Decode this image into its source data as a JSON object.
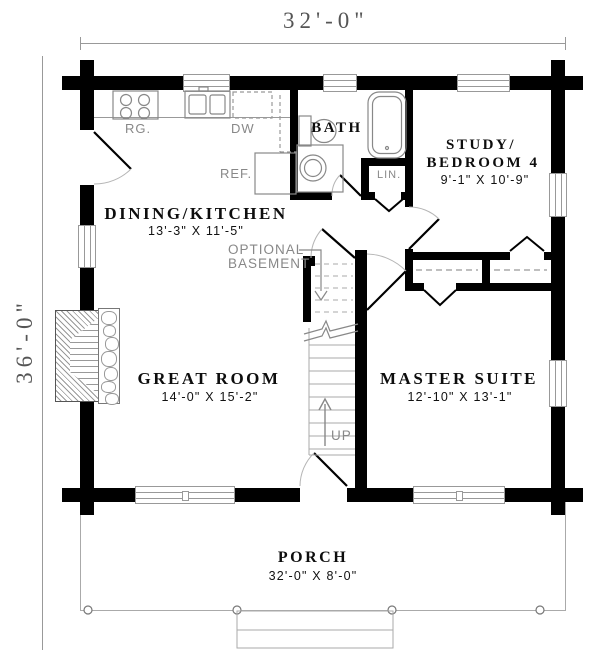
{
  "dimensions": {
    "overall_width": "32'-0\"",
    "overall_depth": "36'-0\""
  },
  "rooms": {
    "dining_kitchen": {
      "name": "DINING/KITCHEN",
      "size": "13'-3\" X 11'-5\""
    },
    "bath": {
      "name": "BATH"
    },
    "study": {
      "name_line1": "STUDY/",
      "name_line2": "BEDROOM 4",
      "size": "9'-1\" X 10'-9\""
    },
    "great_room": {
      "name": "GREAT ROOM",
      "size": "14'-0\" X 15'-2\""
    },
    "master_suite": {
      "name": "MASTER SUITE",
      "size": "12'-10\" X 13'-1\""
    },
    "porch": {
      "name": "PORCH",
      "size": "32'-0\" X 8'-0\""
    }
  },
  "fixtures": {
    "range": "RG.",
    "dishwasher": "DW",
    "refrigerator": "REF.",
    "linen_closet": "LIN."
  },
  "stairs": {
    "up_label": "UP",
    "basement_note_line1": "OPTIONAL",
    "basement_note_line2": "BASEMENT"
  },
  "colors": {
    "wall": "#000000",
    "thin_line": "#999999",
    "fixture_label": "#888888",
    "text": "#111111",
    "background": "#ffffff"
  }
}
